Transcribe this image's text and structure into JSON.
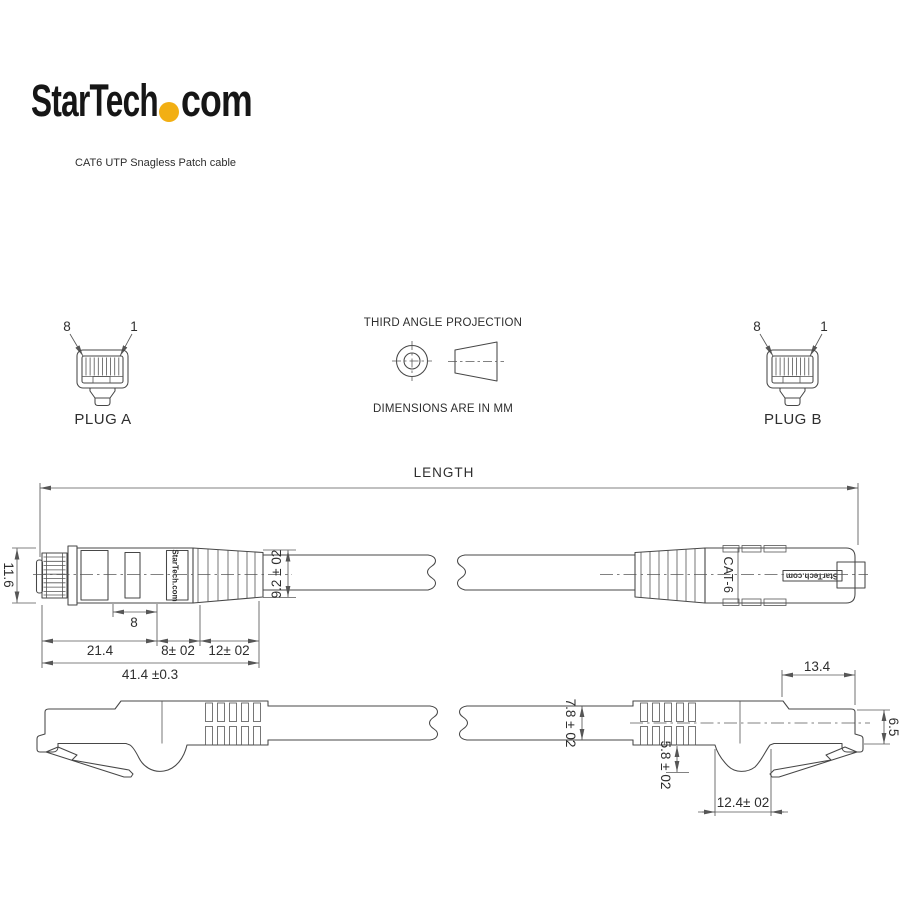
{
  "brand": {
    "logo_before_dot": "StarTech",
    "logo_after_dot": "com",
    "dot_color": "#F2AF13",
    "subtitle": "CAT6 UTP Snagless Patch cable"
  },
  "projection": {
    "title": "THIRD ANGLE PROJECTION",
    "units": "DIMENSIONS ARE IN MM"
  },
  "plugs": {
    "a": {
      "name": "PLUG A",
      "pin8": "8",
      "pin1": "1"
    },
    "b": {
      "name": "PLUG B",
      "pin8": "8",
      "pin1": "1"
    }
  },
  "length": {
    "label": "LENGTH"
  },
  "top_view": {
    "brand_marking": "StarTech.com",
    "cat6_marking": "CAT-6",
    "plug_b_brand_marking": "StarTech.com",
    "dims": {
      "plug_height": "11.6",
      "window_width": "8",
      "plug_body": "21.4",
      "mid_section": "8± 02",
      "boot_section": "12± 02",
      "overall": "41.4 ±0.3",
      "boot_end_dia": "9.2 ± 02"
    }
  },
  "side_view": {
    "dims": {
      "cable_dia": "7.8 ± 02",
      "front_len": "13.4",
      "front_height": "6.5",
      "boot_bump_depth": "5.8 ± 02",
      "boot_bump_width": "12.4± 02"
    }
  }
}
